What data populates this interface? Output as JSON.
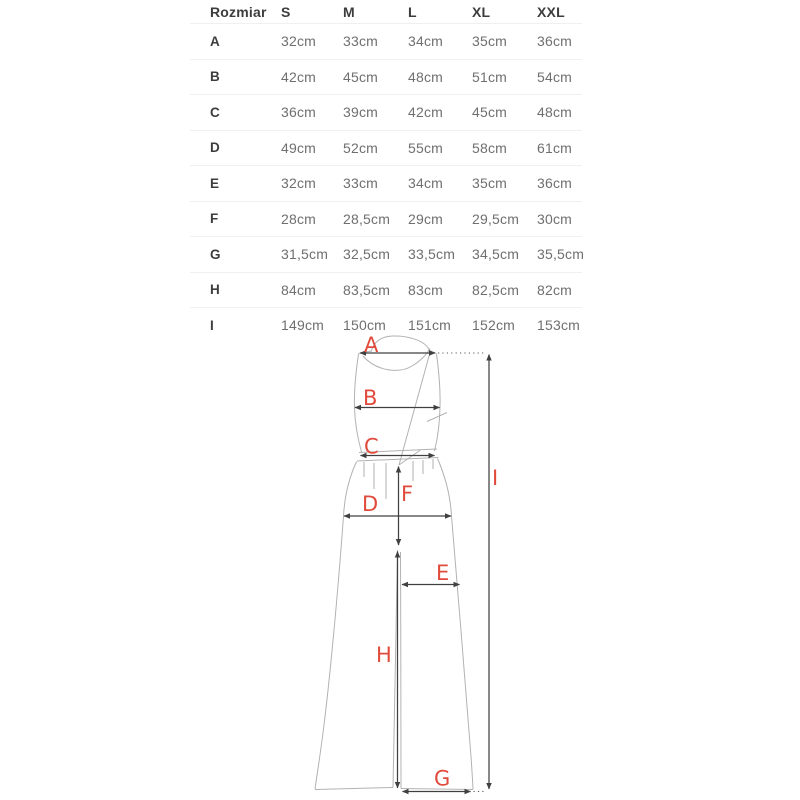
{
  "colors": {
    "label_red": "#e04b3b",
    "measure_line": "#404040",
    "garment_outline": "#b2b2b2",
    "header_text": "#3d3d3d",
    "value_text": "#6f6f6f",
    "divider": "#f0f0f0",
    "background": "#ffffff"
  },
  "size_table": {
    "header": [
      "Rozmiar",
      "S",
      "M",
      "L",
      "XL",
      "XXL"
    ],
    "rows": [
      {
        "label": "A",
        "values": [
          "32cm",
          "33cm",
          "34cm",
          "35cm",
          "36cm"
        ]
      },
      {
        "label": "B",
        "values": [
          "42cm",
          "45cm",
          "48cm",
          "51cm",
          "54cm"
        ]
      },
      {
        "label": "C",
        "values": [
          "36cm",
          "39cm",
          "42cm",
          "45cm",
          "48cm"
        ]
      },
      {
        "label": "D",
        "values": [
          "49cm",
          "52cm",
          "55cm",
          "58cm",
          "61cm"
        ]
      },
      {
        "label": "E",
        "values": [
          "32cm",
          "33cm",
          "34cm",
          "35cm",
          "36cm"
        ]
      },
      {
        "label": "F",
        "values": [
          "28cm",
          "28,5cm",
          "29cm",
          "29,5cm",
          "30cm"
        ]
      },
      {
        "label": "G",
        "values": [
          "31,5cm",
          "32,5cm",
          "33,5cm",
          "34,5cm",
          "35,5cm"
        ]
      },
      {
        "label": "H",
        "values": [
          "84cm",
          "83,5cm",
          "83cm",
          "82,5cm",
          "82cm"
        ]
      },
      {
        "label": "I",
        "values": [
          "149cm",
          "150cm",
          "151cm",
          "152cm",
          "153cm"
        ]
      }
    ]
  },
  "diagram": {
    "labels": [
      {
        "char": "A"
      },
      {
        "char": "B"
      },
      {
        "char": "C"
      },
      {
        "char": "D"
      },
      {
        "char": "E"
      },
      {
        "char": "F"
      },
      {
        "char": "G"
      },
      {
        "char": "H"
      },
      {
        "char": "I"
      }
    ]
  },
  "chart_data": {
    "type": "table",
    "columns": [
      "Rozmiar",
      "S",
      "M",
      "L",
      "XL",
      "XXL"
    ],
    "rows": [
      [
        "A",
        "32cm",
        "33cm",
        "34cm",
        "35cm",
        "36cm"
      ],
      [
        "B",
        "42cm",
        "45cm",
        "48cm",
        "51cm",
        "54cm"
      ],
      [
        "C",
        "36cm",
        "39cm",
        "42cm",
        "45cm",
        "48cm"
      ],
      [
        "D",
        "49cm",
        "52cm",
        "55cm",
        "58cm",
        "61cm"
      ],
      [
        "E",
        "32cm",
        "33cm",
        "34cm",
        "35cm",
        "36cm"
      ],
      [
        "F",
        "28cm",
        "28,5cm",
        "29cm",
        "29,5cm",
        "30cm"
      ],
      [
        "G",
        "31,5cm",
        "32,5cm",
        "33,5cm",
        "34,5cm",
        "35,5cm"
      ],
      [
        "H",
        "84cm",
        "83,5cm",
        "83cm",
        "82,5cm",
        "82cm"
      ],
      [
        "I",
        "149cm",
        "150cm",
        "151cm",
        "152cm",
        "153cm"
      ]
    ]
  }
}
